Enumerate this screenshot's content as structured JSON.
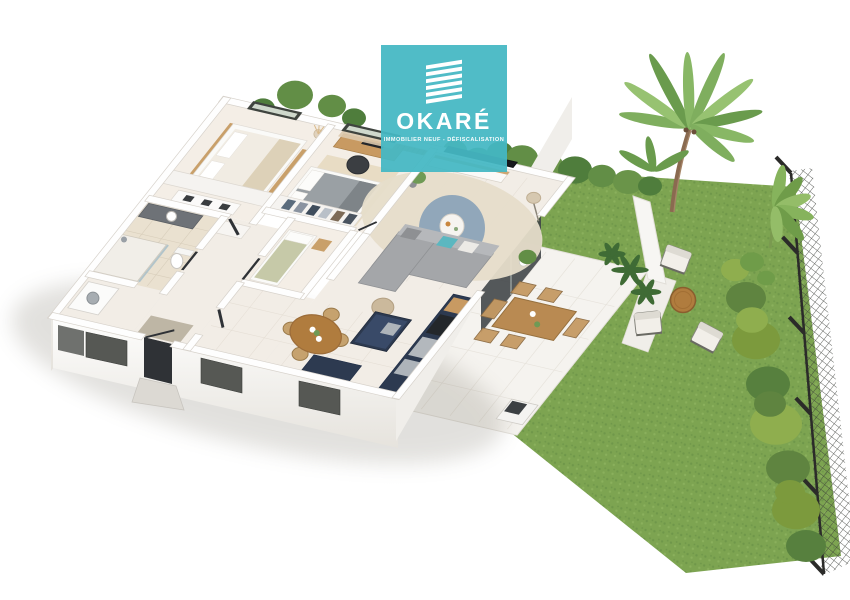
{
  "brand": {
    "name": "OKARÉ",
    "tagline": "IMMOBILIER NEUF - DÉFISCALISATION",
    "logo_icon": "stacked-building-slabs-icon",
    "color": "#45b8c3"
  },
  "scene": {
    "type": "3d-floor-plan-render",
    "view": "isometric-dollhouse",
    "rooms": [
      {
        "name": "Chambre 1",
        "furniture": [
          "lit double blanc",
          "tête de lit bois",
          "banc bois",
          "commode",
          "vase pampas"
        ]
      },
      {
        "name": "Chambre 2 (master)",
        "furniture": [
          "lit double gris",
          "bureau bois",
          "chaise noire",
          "penderie ouverte",
          "rideaux",
          "claustra bois"
        ]
      },
      {
        "name": "Chambre 3",
        "furniture": [
          "lit simple sauge",
          "chevet bois"
        ]
      },
      {
        "name": "Salle de bains",
        "furniture": [
          "douche vitrée",
          "meuble vasque gris",
          "WC",
          "lave-linge"
        ]
      },
      {
        "name": "Entrée",
        "furniture": [
          "porte d'entrée",
          "tapis",
          "marches extérieures"
        ]
      },
      {
        "name": "Séjour",
        "furniture": [
          "canapé d'angle gris",
          "coussin turquoise",
          "TV murale",
          "meuble TV",
          "grand tapis beige",
          "tapis rond bleu",
          "table basse ronde",
          "lampadaire",
          "pouf",
          "plante verte"
        ]
      },
      {
        "name": "Salle à manger",
        "furniture": [
          "table ronde bois",
          "4 chaises",
          "buffet bleu nuit"
        ]
      },
      {
        "name": "Cuisine",
        "furniture": [
          "meubles bleu nuit",
          "îlot central",
          "four",
          "électroménager inox",
          "étagère bois"
        ]
      },
      {
        "name": "Terrasse",
        "furniture": [
          "table extérieure bois",
          "6 chaises",
          "barbecue",
          "plante en pot"
        ]
      }
    ],
    "garden": {
      "elements": [
        "pelouse",
        "haies",
        "palmier",
        "bananiers",
        "fougères",
        "mur de jardin blanc",
        "clôture grillagée noire",
        "volets extérieurs gris"
      ],
      "furniture": [
        "3 fauteuils lounge blancs",
        "table basse ronde bois"
      ]
    },
    "facade": [
      "volet fenêtre x3",
      "porte d'entrée sombre",
      "rampe sombre",
      "baie vitrée noire"
    ]
  },
  "palette": {
    "background": "#ffffff",
    "brand_teal": "#45b8c3",
    "grass_green": "#7da451",
    "grass_dark": "#6f974a",
    "grass_light": "#8ab05c",
    "hedge_green": "#628e46",
    "hedge_dark": "#4f7d3c",
    "hedge_light": "#8fae4e",
    "palm_green": "#7fae5e",
    "trunk_brown": "#8a6a50",
    "wall_white": "#fefefe",
    "floor_beige": "#f2ede6",
    "floor_warm": "#f4eee6",
    "bath_tile": "#eae1d0",
    "kitchen_navy": "#2d3a50",
    "wood": "#c89a62",
    "wood_dark": "#b07c3e",
    "sofa_grey": "#a4a6a9",
    "rug_beige": "#e6ddca",
    "rug_blue": "#8aa2b8",
    "fence_dark": "#2b2b29",
    "shutter_grey": "#565854",
    "paving": "#f5f3ef",
    "door_dark": "#2f3236"
  }
}
